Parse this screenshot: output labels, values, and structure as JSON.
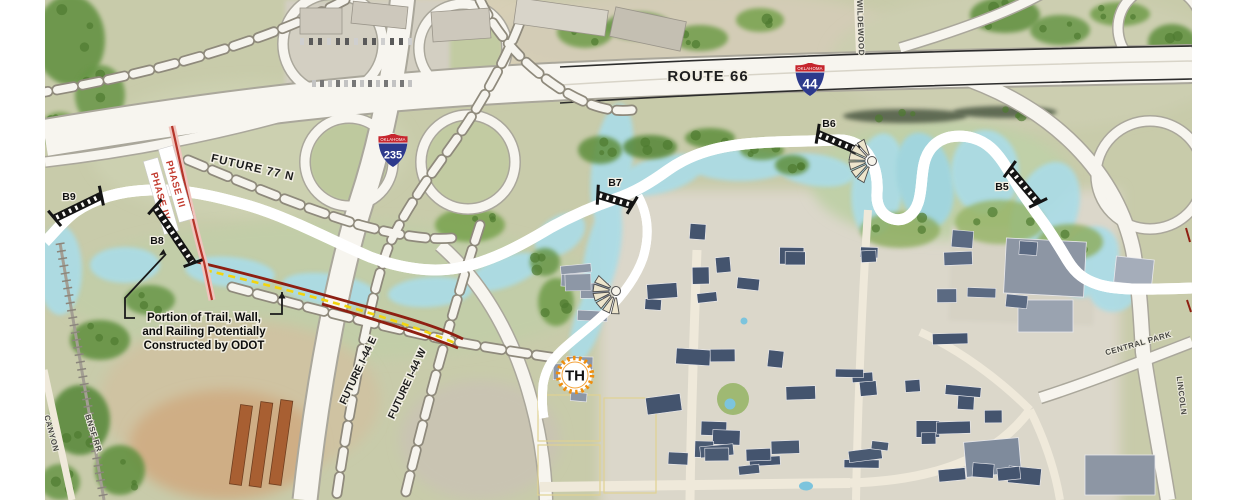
{
  "labels": {
    "route66": "ROUTE 66",
    "future77n": "FUTURE 77 N",
    "future_i44_e": "FUTURE I-44 E",
    "future_i44_w": "FUTURE I-44 W",
    "wildewood": "WILDEWOOD",
    "central_park": "CENTRAL PARK",
    "lincoln": "LINCOLN",
    "canyon": "CANYON",
    "bnsf_rr": "BNSF RR"
  },
  "phases": {
    "phase3": "PHASE III",
    "phase4": "PHASE IV"
  },
  "bridges": {
    "b5": "B5",
    "b6": "B6",
    "b7": "B7",
    "b8": "B8",
    "b9": "B9"
  },
  "shields": {
    "i44": {
      "state": "OKLAHOMA",
      "number": "44"
    },
    "i235": {
      "state": "OKLAHOMA",
      "number": "235"
    }
  },
  "trailhead": {
    "label": "TH"
  },
  "annotation": {
    "lines": [
      "Portion of Trail, Wall,",
      "and Railing Potentially",
      "Constructed by ODOT"
    ]
  },
  "colors": {
    "trail_orange": "#EF9326",
    "planned_trail_pink": "#BF5FA4",
    "wall_dark_red": "#8E1F12",
    "phase_line_red": "#B5352A",
    "yellow_dash": "#F2D40E",
    "creek_blue": "#AADCE6",
    "trailhead_ring_orange": "#EF8E0E"
  }
}
